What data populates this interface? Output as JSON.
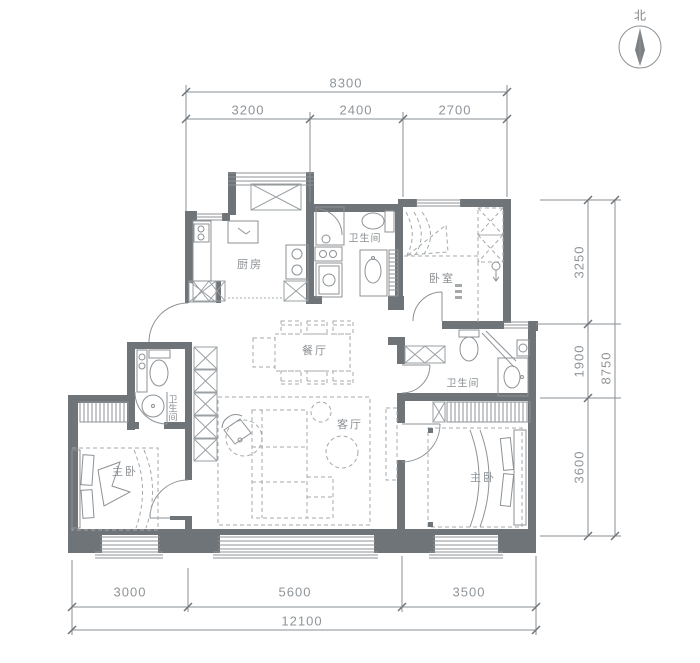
{
  "compass": {
    "north_label": "北"
  },
  "dimensions": {
    "top": {
      "total": "8300",
      "segments": [
        "3200",
        "2400",
        "2700"
      ]
    },
    "right": {
      "total": "8750",
      "segments": [
        "3250",
        "1900",
        "3600"
      ]
    },
    "bottom": {
      "total": "12100",
      "segments": [
        "3000",
        "5600",
        "3500"
      ]
    }
  },
  "rooms": {
    "kitchen": "厨房",
    "bath_top": "卫生间",
    "bedroom_top": "卧室",
    "dining": "餐厅",
    "living": "客厅",
    "bath_left": "卫生间",
    "bedroom_left": "主卧",
    "bath_right": "卫生间",
    "bedroom_right": "主卧"
  },
  "colors": {
    "wall": "#6f7478",
    "line": "#8d9296",
    "dimension": "#8a8f93",
    "furniture_dash": "#a4a9ac",
    "background": "#ffffff"
  }
}
